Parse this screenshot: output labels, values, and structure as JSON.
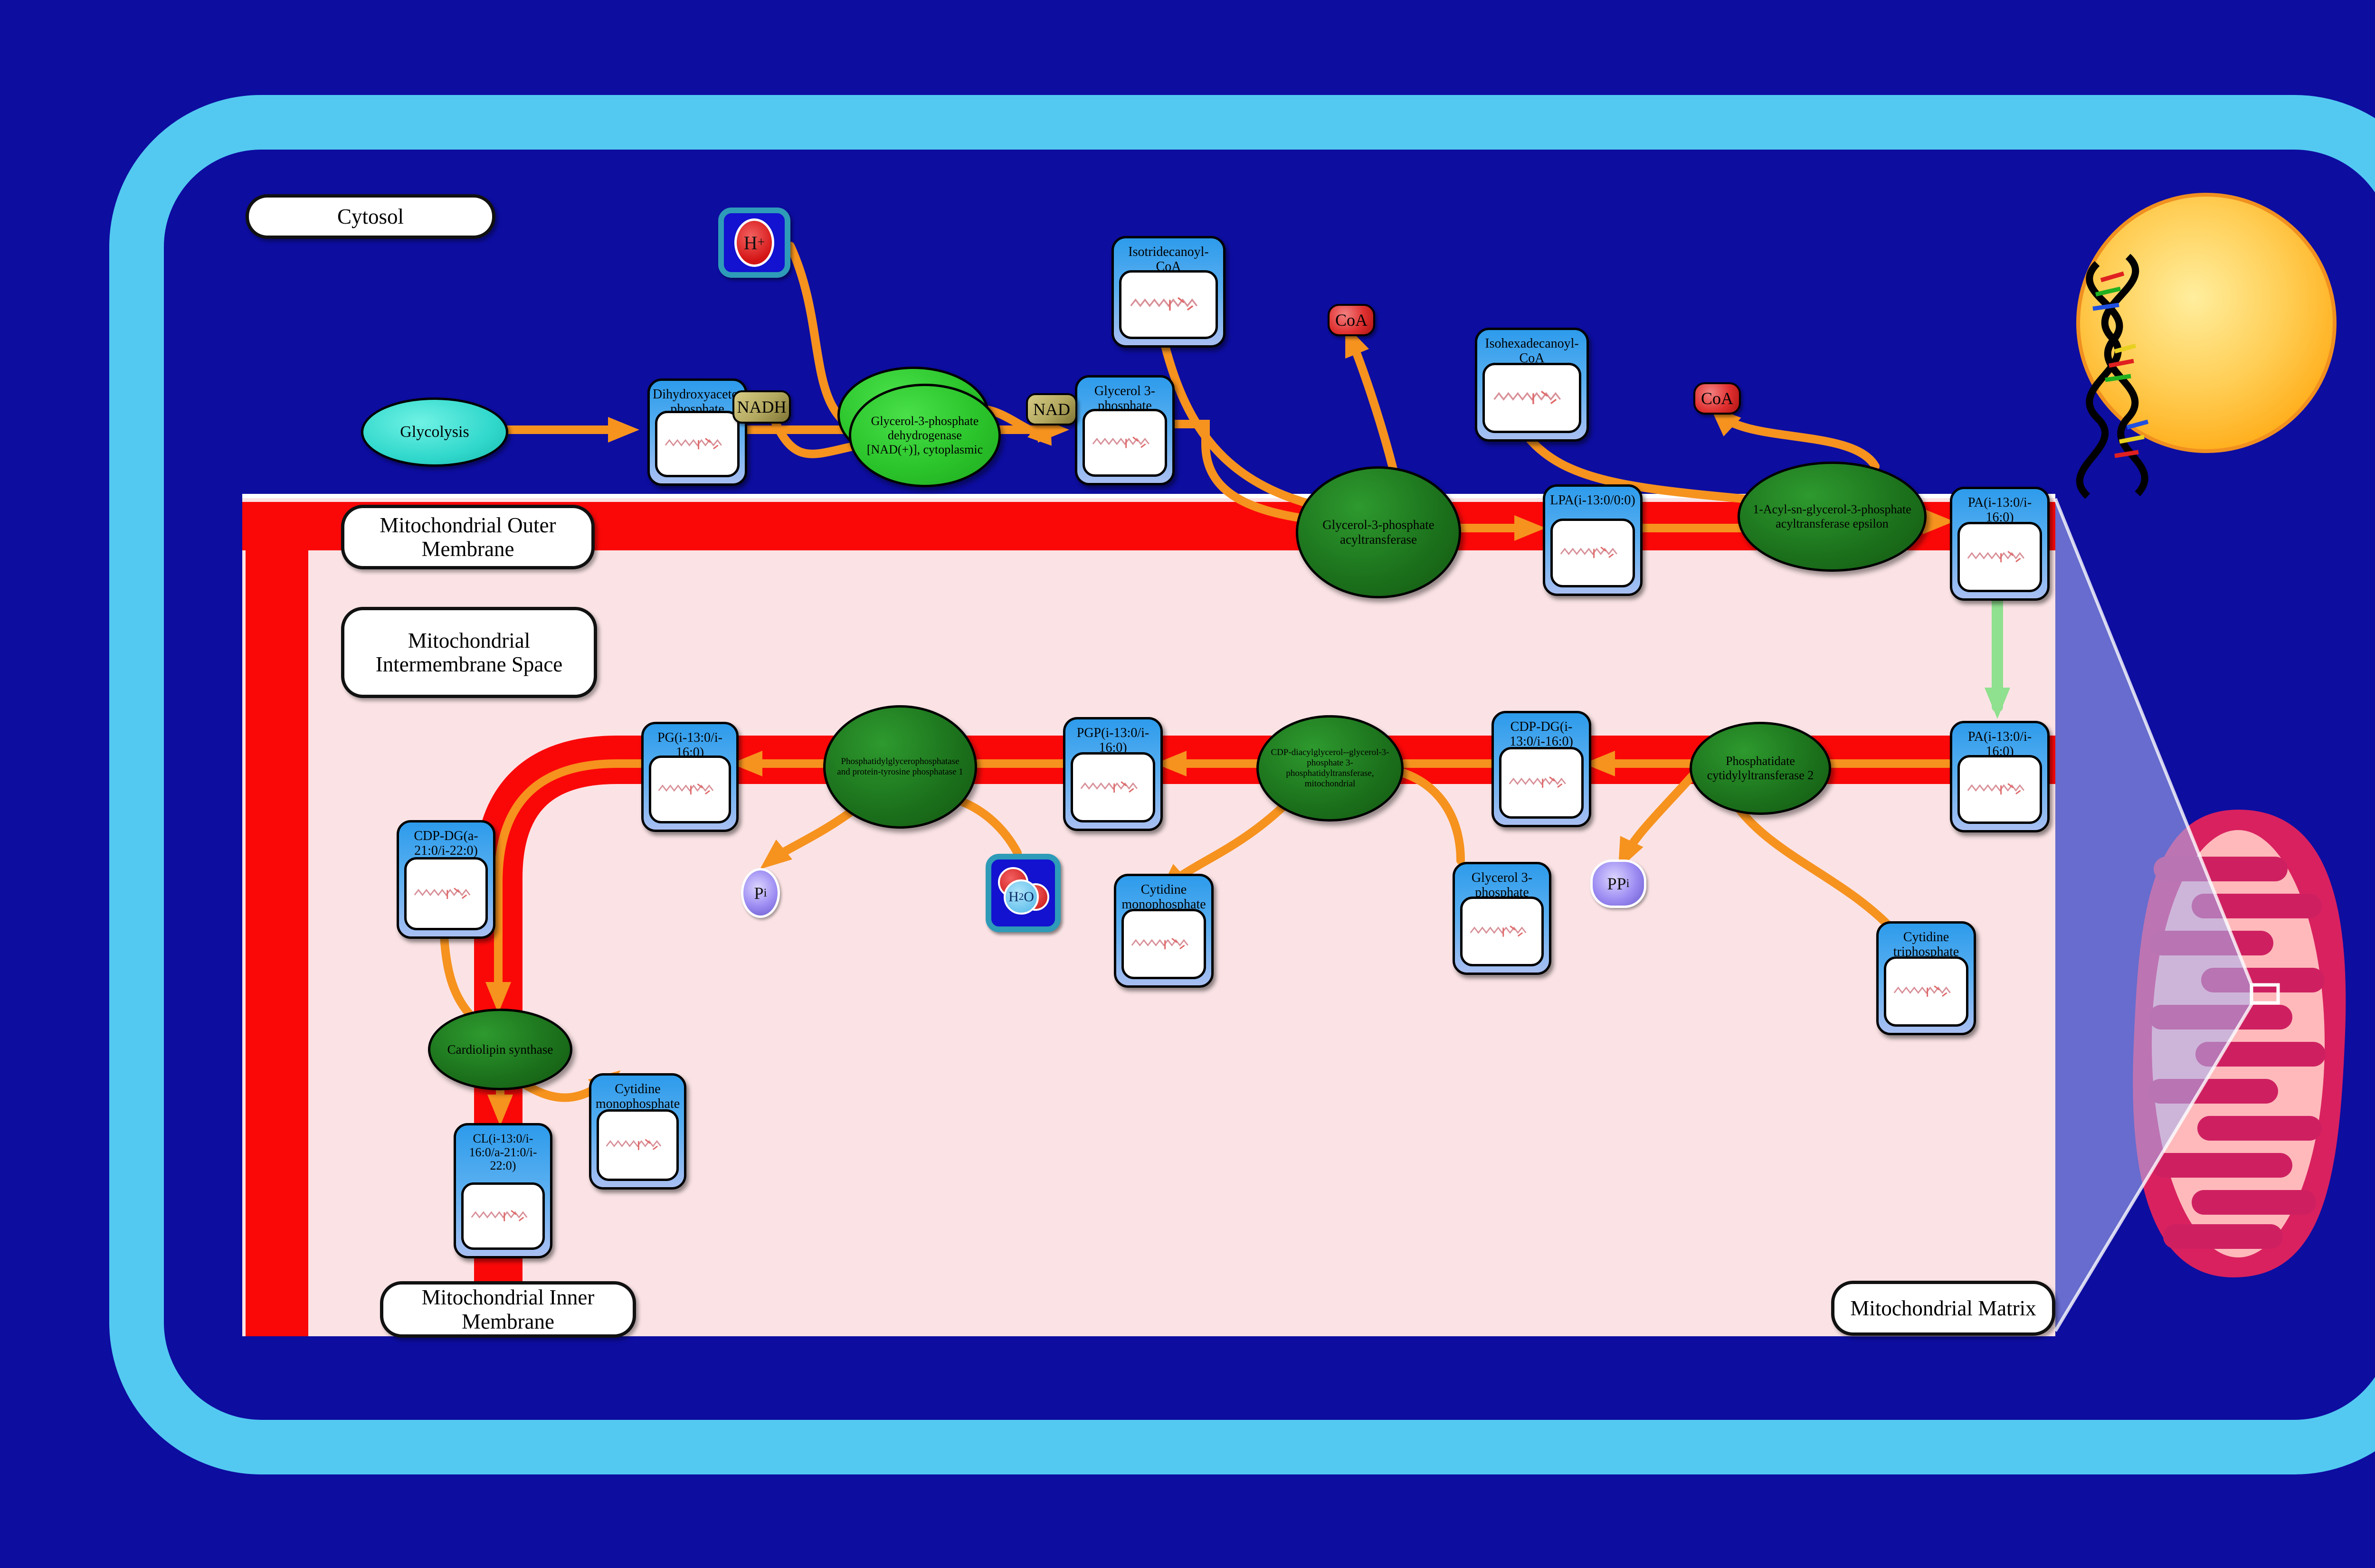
{
  "regions": {
    "cytosol": "Cytosol",
    "outer_membrane": "Mitochondrial Outer Membrane",
    "intermembrane_space": "Mitochondrial Intermembrane Space",
    "inner_membrane": "Mitochondrial Inner Membrane",
    "matrix": "Mitochondrial Matrix"
  },
  "process": {
    "glycolysis": "Glycolysis"
  },
  "metabolites": {
    "dhap": "Dihydroxyacetone phosphate",
    "g3p_cytosol": "Glycerol 3-phosphate",
    "isotridecanoyl_coa": "Isotridecanoyl-CoA",
    "isohexadecanoyl_coa": "Isohexadecanoyl-CoA",
    "lpa": "LPA(i-13:0/0:0)",
    "pa_outer": "PA(i-13:0/i-16:0)",
    "pa_inner": "PA(i-13:0/i-16:0)",
    "cdp_dg_1": "CDP-DG(i-13:0/i-16:0)",
    "pgp": "PGP(i-13:0/i-16:0)",
    "pg": "PG(i-13:0/i-16:0)",
    "ctp": "Cytidine triphosphate",
    "g3p_matrix": "Glycerol 3-phosphate",
    "cmp_matrix": "Cytidine monophosphate",
    "cdp_dg_2": "CDP-DG(a-21:0/i-22:0)",
    "cardiolipin": "CL(i-13:0/i-16:0/a-21:0/i-22:0)",
    "cmp_synthase": "Cytidine monophosphate"
  },
  "enzymes": {
    "gpd_cytoplasmic": "Glycerol-3-phosphate dehydrogenase [NAD(+)], cytoplasmic",
    "gpat": "Glycerol-3-phosphate acyltransferase",
    "agpat_epsilon": "1-Acyl-sn-glycerol-3-phosphate acyltransferase epsilon",
    "pct2": "Phosphatidate cytidylyltransferase 2",
    "cds_mito": "CDP-diacylglycerol--glycerol-3-phosphate 3-phosphatidyltransferase, mitochondrial",
    "pgp_phosphatase": "Phosphatidylglycerophosphatase and protein-tyrosine phosphatase 1",
    "cardiolipin_synthase": "Cardiolipin synthase"
  },
  "cofactors": {
    "nadh": "NADH",
    "nad": "NAD",
    "coa_1": "CoA",
    "coa_2": "CoA",
    "h_base": "H",
    "h_sup": "+",
    "h2o_h": "H",
    "h2o_sub": "2",
    "h2o_o": "O",
    "pi_base": "P",
    "pi_sub": "i",
    "ppi_base": "PP",
    "ppi_sub": "i"
  },
  "colors": {
    "background": "#0D0DA0",
    "cell_border": "#53C9F1",
    "membrane_red": "#FA0808",
    "compartment_pink": "#FBE3E5",
    "node_blue": "#2D9BEB",
    "enzyme_green_dark": "#1B701B",
    "enzyme_green_bright": "#2BC42B",
    "arrow_orange": "#F6921E",
    "arrow_green": "#8FE08F",
    "nucleus_gold": "#FFB020",
    "mitochondrion_crimson": "#D9215F",
    "mitochondrion_inner_pink": "#FFB9BB"
  }
}
